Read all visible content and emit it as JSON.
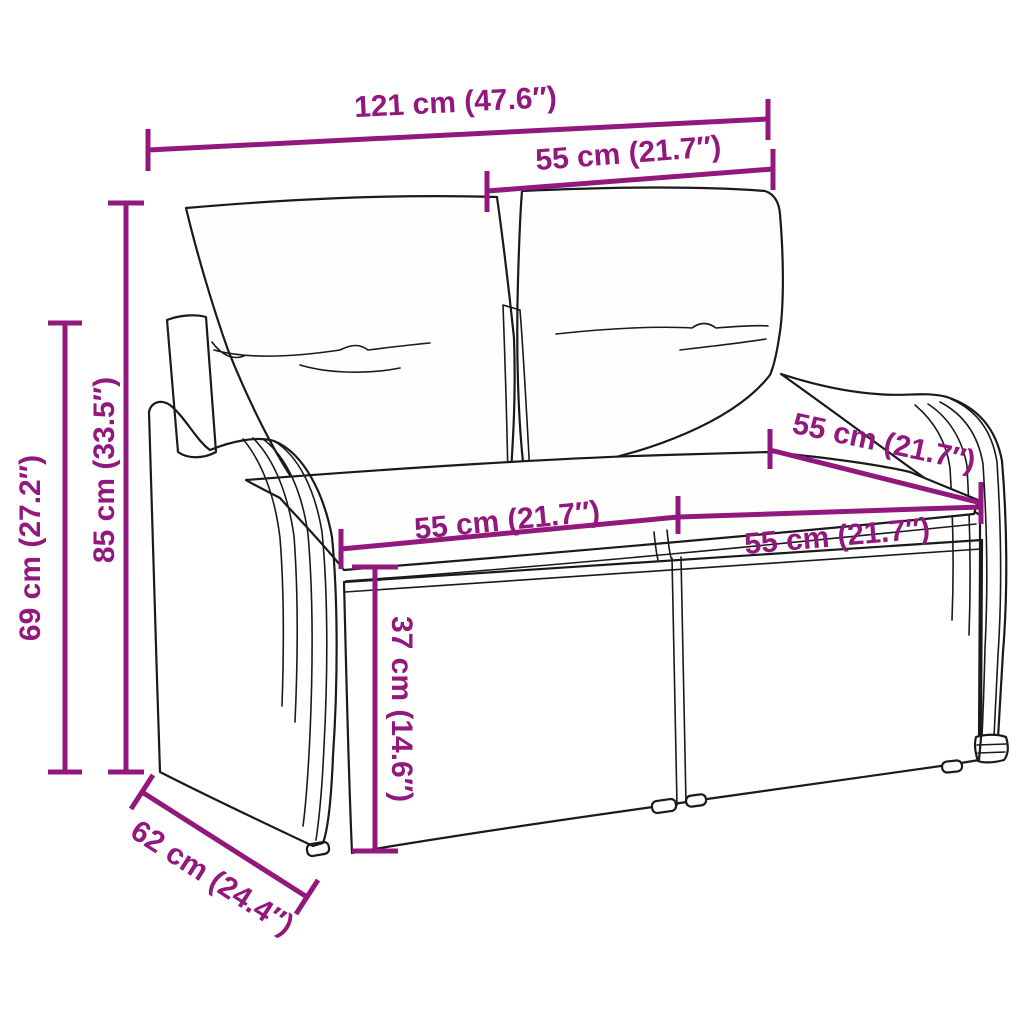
{
  "figure": {
    "type": "product-dimension-diagram",
    "subject": "poly rattan 2-seater garden sofa with back and seat cushions",
    "accent_color": "#92187d",
    "outline_color": "#1a1a1a",
    "background_color": "#ffffff",
    "dimensions": [
      {
        "id": "overall-width",
        "cm": 121,
        "inch": 47.6,
        "label": "121 cm (47.6″)"
      },
      {
        "id": "back-width",
        "cm": 55,
        "inch": 21.7,
        "label": "55 cm (21.7″)"
      },
      {
        "id": "arm-height",
        "cm": 69,
        "inch": 27.2,
        "label": "69 cm (27.2″)"
      },
      {
        "id": "overall-height",
        "cm": 85,
        "inch": 33.5,
        "label": "85 cm (33.5″)"
      },
      {
        "id": "seat-width-left",
        "cm": 55,
        "inch": 21.7,
        "label": "55 cm (21.7″)"
      },
      {
        "id": "seat-width-right",
        "cm": 55,
        "inch": 21.7,
        "label": "55 cm (21.7″)"
      },
      {
        "id": "seat-depth",
        "cm": 55,
        "inch": 21.7,
        "label": "55 cm (21.7″)"
      },
      {
        "id": "seat-height",
        "cm": 37,
        "inch": 14.6,
        "label": "37 cm (14.6″)"
      },
      {
        "id": "base-depth",
        "cm": 62,
        "inch": 24.4,
        "label": "62 cm (24.4″)"
      }
    ]
  }
}
